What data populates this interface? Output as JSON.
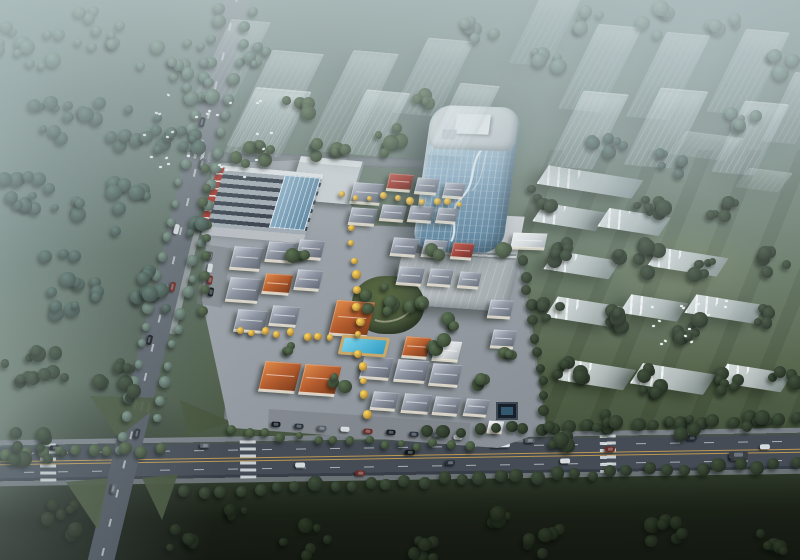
{
  "scene": {
    "kind": "aerial-architectural-rendering",
    "time_of_day": "hazy dusk",
    "no_visible_text": true
  },
  "palette": {
    "mist": "#c3d2d2",
    "lawn_streak": "rgba(22,30,15,0.16)",
    "road_fill_main": "#454c56",
    "road_fill_minor": "#6d747c",
    "sidewalk": "#7a8088",
    "lane_yellow": "#c9a050",
    "lane_white": "rgba(235,240,243,0.6)",
    "median_green": "#46543c",
    "town_base": "#9aa1a8",
    "plaza": "#c6cacd",
    "bigbox_light": "#c2c7ca",
    "bigbox_dark": "#9fa6aa",
    "glass_light": "#cfe0ea",
    "glass_mid": "#8fb4cc",
    "glass_dark": "#4f7894",
    "tower_roof": "#dde2e4",
    "mall_stripe_dark": "#39424d",
    "mall_stripe_light": "#a2abb3",
    "mall_red": "#ab342a",
    "mall_white": "#dfe3e5",
    "pool_light": "#7fd4ea",
    "pool_dark": "#2f9cc4",
    "deck_tan": "#c9a86b",
    "fountain_dark": "#17202a",
    "tree_colors": {
      "hazy": "#5a6d64",
      "forest": "#42544d",
      "dark": "#2e3a2b",
      "mid": "#41513b",
      "yellow": "#c69c42",
      "field": "#20291c"
    },
    "roof_gradients": {
      "grey": "linear-gradient(140deg,#c7ccd6 0%,#8d94a1 45%,#616874 100%)",
      "orange": "linear-gradient(140deg,#e08c4c 0%,#b45c2e 50%,#7c3c1d 100%)",
      "red": "linear-gradient(140deg,#c05b4a 0%,#9c382e 50%,#64231c 100%)",
      "white": "linear-gradient(140deg,#f4f6f7 0%,#d9dde0 55%,#aab0b5 100%)"
    },
    "car_colors": [
      "#14181d",
      "#2b313a",
      "#565c64",
      "#d8dcdf",
      "#6e2a24"
    ]
  },
  "roads": {
    "main": {
      "x1": -10,
      "y1": 457,
      "x2": 810,
      "y2": 457,
      "width": 46,
      "rot_deg": -0.9
    },
    "diagonal": {
      "x1": 238,
      "y1": -6,
      "x2": 100,
      "y2": 565,
      "width": 26,
      "rot_deg": 13.6
    },
    "south_street": {
      "x": 224,
      "y": 416,
      "w": 300,
      "h": 16,
      "rot": 4
    },
    "north_street": {
      "x": 206,
      "y": 156,
      "w": 272,
      "h": 10,
      "rot": 2
    },
    "access_east": {
      "x": 522,
      "y": 258,
      "w": 13,
      "h": 176,
      "rot": -8
    },
    "town_ns": {
      "x": 348,
      "y": 226,
      "w": 12,
      "h": 192,
      "rot": 5
    },
    "town_ew": {
      "x": 234,
      "y": 326,
      "w": 202,
      "h": 10,
      "rot": 4
    }
  },
  "zebras_main_t": [
    58,
    258,
    618
  ],
  "zebras_diag_t": [
    160,
    418
  ],
  "medians": [
    {
      "pts": "90px 396px, 168px 398px, 118px 438px"
    },
    {
      "pts": "180px 400px, 232px 422px, 188px 436px"
    },
    {
      "pts": "66px 482px, 108px 478px, 98px 530px"
    },
    {
      "pts": "142px 478px, 178px 474px, 162px 520px"
    }
  ],
  "ghost_towers": [
    {
      "x": 275,
      "y": 100,
      "w": 52,
      "h": 98,
      "o": 0.5
    },
    {
      "x": 352,
      "y": 102,
      "w": 46,
      "h": 102,
      "o": 0.5
    },
    {
      "x": 433,
      "y": 77,
      "w": 46,
      "h": 76,
      "o": 0.5
    },
    {
      "x": 268,
      "y": 122,
      "w": 56,
      "h": 66,
      "o": 0.65
    },
    {
      "x": 373,
      "y": 123,
      "w": 44,
      "h": 64,
      "o": 0.65
    },
    {
      "x": 463,
      "y": 120,
      "w": 40,
      "h": 72,
      "o": 0.55
    },
    {
      "x": 600,
      "y": 68,
      "w": 44,
      "h": 86,
      "o": 0.55
    },
    {
      "x": 668,
      "y": 76,
      "w": 44,
      "h": 86,
      "o": 0.55
    },
    {
      "x": 748,
      "y": 72,
      "w": 44,
      "h": 84,
      "o": 0.55
    },
    {
      "x": 588,
      "y": 130,
      "w": 46,
      "h": 76,
      "o": 0.65
    },
    {
      "x": 666,
      "y": 128,
      "w": 48,
      "h": 78,
      "o": 0.65
    },
    {
      "x": 750,
      "y": 138,
      "w": 44,
      "h": 72,
      "o": 0.65
    },
    {
      "x": 795,
      "y": 108,
      "w": 34,
      "h": 70,
      "o": 0.5
    },
    {
      "x": 545,
      "y": 30,
      "w": 40,
      "h": 70,
      "o": 0.4
    },
    {
      "x": 232,
      "y": 60,
      "w": 40,
      "h": 80,
      "o": 0.4
    }
  ],
  "ghost_plates": [
    {
      "x": 706,
      "y": 146,
      "w": 58,
      "h": 24,
      "o": 0.4
    },
    {
      "x": 764,
      "y": 180,
      "w": 44,
      "h": 20,
      "o": 0.35
    }
  ],
  "slabs": [
    {
      "x": 590,
      "y": 182,
      "w": 96,
      "h": 20
    },
    {
      "x": 570,
      "y": 217,
      "w": 64,
      "h": 20
    },
    {
      "x": 634,
      "y": 222,
      "w": 62,
      "h": 20
    },
    {
      "x": 582,
      "y": 265,
      "w": 66,
      "h": 20
    },
    {
      "x": 688,
      "y": 262,
      "w": 70,
      "h": 20
    },
    {
      "x": 586,
      "y": 312,
      "w": 70,
      "h": 22
    },
    {
      "x": 654,
      "y": 308,
      "w": 58,
      "h": 20
    },
    {
      "x": 725,
      "y": 309,
      "w": 70,
      "h": 20
    },
    {
      "x": 597,
      "y": 375,
      "w": 66,
      "h": 22
    },
    {
      "x": 673,
      "y": 379,
      "w": 74,
      "h": 22
    },
    {
      "x": 754,
      "y": 378,
      "w": 66,
      "h": 20
    }
  ],
  "houses": [
    {
      "x": 352,
      "y": 183,
      "w": 30,
      "h": 20,
      "rot": 4,
      "roof": "grey"
    },
    {
      "x": 388,
      "y": 174,
      "w": 24,
      "h": 16,
      "rot": 4,
      "roof": "red"
    },
    {
      "x": 416,
      "y": 178,
      "w": 22,
      "h": 15,
      "rot": 4,
      "roof": "grey"
    },
    {
      "x": 444,
      "y": 183,
      "w": 20,
      "h": 14,
      "rot": 4,
      "roof": "grey"
    },
    {
      "x": 350,
      "y": 208,
      "w": 26,
      "h": 16,
      "rot": 4,
      "roof": "grey"
    },
    {
      "x": 381,
      "y": 205,
      "w": 24,
      "h": 15,
      "rot": 4,
      "roof": "grey"
    },
    {
      "x": 409,
      "y": 206,
      "w": 24,
      "h": 15,
      "rot": 4,
      "roof": "grey"
    },
    {
      "x": 437,
      "y": 208,
      "w": 20,
      "h": 14,
      "rot": 4,
      "roof": "grey"
    },
    {
      "x": 512,
      "y": 233,
      "w": 34,
      "h": 15,
      "rot": 2,
      "roof": "white"
    },
    {
      "x": 232,
      "y": 247,
      "w": 30,
      "h": 22,
      "rot": 4,
      "roof": "grey"
    },
    {
      "x": 267,
      "y": 242,
      "w": 27,
      "h": 19,
      "rot": 4,
      "roof": "grey"
    },
    {
      "x": 298,
      "y": 240,
      "w": 25,
      "h": 18,
      "rot": 4,
      "roof": "grey"
    },
    {
      "x": 228,
      "y": 278,
      "w": 32,
      "h": 23,
      "rot": 4,
      "roof": "grey"
    },
    {
      "x": 264,
      "y": 274,
      "w": 27,
      "h": 19,
      "rot": 4,
      "roof": "orange"
    },
    {
      "x": 296,
      "y": 270,
      "w": 25,
      "h": 19,
      "rot": 4,
      "roof": "grey"
    },
    {
      "x": 236,
      "y": 310,
      "w": 30,
      "h": 21,
      "rot": 4,
      "roof": "grey"
    },
    {
      "x": 271,
      "y": 306,
      "w": 27,
      "h": 19,
      "rot": 4,
      "roof": "grey"
    },
    {
      "x": 392,
      "y": 238,
      "w": 25,
      "h": 17,
      "rot": 4,
      "roof": "grey"
    },
    {
      "x": 423,
      "y": 240,
      "w": 23,
      "h": 16,
      "rot": 4,
      "roof": "grey"
    },
    {
      "x": 452,
      "y": 243,
      "w": 21,
      "h": 15,
      "rot": 4,
      "roof": "red"
    },
    {
      "x": 398,
      "y": 267,
      "w": 25,
      "h": 17,
      "rot": 4,
      "roof": "grey"
    },
    {
      "x": 429,
      "y": 269,
      "w": 23,
      "h": 16,
      "rot": 4,
      "roof": "grey"
    },
    {
      "x": 459,
      "y": 272,
      "w": 21,
      "h": 15,
      "rot": 4,
      "roof": "grey"
    },
    {
      "x": 333,
      "y": 301,
      "w": 38,
      "h": 34,
      "rot": 4,
      "roof": "orange"
    },
    {
      "x": 489,
      "y": 300,
      "w": 23,
      "h": 17,
      "rot": 3,
      "roof": "grey"
    },
    {
      "x": 492,
      "y": 330,
      "w": 23,
      "h": 17,
      "rot": 3,
      "roof": "grey"
    },
    {
      "x": 262,
      "y": 362,
      "w": 36,
      "h": 29,
      "rot": 4,
      "roof": "orange"
    },
    {
      "x": 302,
      "y": 365,
      "w": 36,
      "h": 29,
      "rot": 4,
      "roof": "orange"
    },
    {
      "x": 404,
      "y": 337,
      "w": 25,
      "h": 20,
      "rot": 4,
      "roof": "orange"
    },
    {
      "x": 434,
      "y": 341,
      "w": 26,
      "h": 19,
      "rot": 4,
      "roof": "white"
    },
    {
      "x": 362,
      "y": 357,
      "w": 29,
      "h": 21,
      "rot": 4,
      "roof": "grey"
    },
    {
      "x": 396,
      "y": 360,
      "w": 31,
      "h": 21,
      "rot": 4,
      "roof": "grey"
    },
    {
      "x": 431,
      "y": 364,
      "w": 29,
      "h": 21,
      "rot": 4,
      "roof": "grey"
    },
    {
      "x": 372,
      "y": 392,
      "w": 25,
      "h": 17,
      "rot": 4,
      "roof": "grey"
    },
    {
      "x": 403,
      "y": 394,
      "w": 27,
      "h": 18,
      "rot": 4,
      "roof": "grey"
    },
    {
      "x": 434,
      "y": 397,
      "w": 25,
      "h": 17,
      "rot": 4,
      "roof": "grey"
    },
    {
      "x": 465,
      "y": 399,
      "w": 23,
      "h": 16,
      "rot": 4,
      "roof": "grey"
    },
    {
      "x": 488,
      "y": 421,
      "w": 15,
      "h": 11,
      "rot": 3,
      "roof": "white"
    }
  ],
  "tree_lines": [
    {
      "x1": 221,
      "y1": 6,
      "x2": 117,
      "y2": 452,
      "n": 26,
      "c": "hazy",
      "s": [
        8,
        13
      ]
    },
    {
      "x1": 251,
      "y1": 10,
      "x2": 158,
      "y2": 418,
      "n": 24,
      "c": "hazy",
      "s": [
        8,
        12
      ]
    },
    {
      "x1": 160,
      "y1": 450,
      "x2": 8,
      "y2": 452,
      "n": 10,
      "c": "mid",
      "s": [
        9,
        13
      ]
    },
    {
      "x1": 430,
      "y1": 432,
      "x2": 795,
      "y2": 418,
      "n": 24,
      "c": "dark",
      "s": [
        10,
        14
      ]
    },
    {
      "x1": 185,
      "y1": 492,
      "x2": 795,
      "y2": 464,
      "n": 34,
      "c": "dark",
      "s": [
        10,
        15
      ]
    },
    {
      "x1": 232,
      "y1": 432,
      "x2": 468,
      "y2": 448,
      "n": 15,
      "c": "mid",
      "s": [
        7,
        10
      ]
    },
    {
      "x1": 524,
      "y1": 262,
      "x2": 548,
      "y2": 428,
      "n": 12,
      "c": "dark",
      "s": [
        9,
        12
      ]
    },
    {
      "x1": 349,
      "y1": 230,
      "x2": 366,
      "y2": 412,
      "n": 13,
      "c": "yellow",
      "s": [
        6,
        9
      ]
    },
    {
      "x1": 238,
      "y1": 330,
      "x2": 332,
      "y2": 338,
      "n": 8,
      "c": "yellow",
      "s": [
        6,
        8
      ]
    },
    {
      "x1": 344,
      "y1": 196,
      "x2": 462,
      "y2": 202,
      "n": 10,
      "c": "yellow",
      "s": [
        5,
        8
      ]
    },
    {
      "x1": 205,
      "y1": 170,
      "x2": 204,
      "y2": 310,
      "n": 9,
      "c": "mid",
      "s": [
        8,
        11
      ]
    }
  ],
  "tree_clusters": [
    {
      "x": 30,
      "y": 45,
      "r": 34,
      "n": 12,
      "c": "hazy"
    },
    {
      "x": 100,
      "y": 28,
      "r": 30,
      "n": 10,
      "c": "hazy"
    },
    {
      "x": 172,
      "y": 58,
      "r": 34,
      "n": 11,
      "c": "hazy"
    },
    {
      "x": 62,
      "y": 112,
      "r": 40,
      "n": 13,
      "c": "forest"
    },
    {
      "x": 142,
      "y": 132,
      "r": 34,
      "n": 11,
      "c": "forest"
    },
    {
      "x": 36,
      "y": 192,
      "r": 38,
      "n": 12,
      "c": "forest"
    },
    {
      "x": 112,
      "y": 208,
      "r": 40,
      "n": 13,
      "c": "forest"
    },
    {
      "x": 62,
      "y": 282,
      "r": 44,
      "n": 14,
      "c": "forest"
    },
    {
      "x": 152,
      "y": 292,
      "r": 32,
      "n": 10,
      "c": "forest"
    },
    {
      "x": 42,
      "y": 362,
      "r": 40,
      "n": 12,
      "c": "dark"
    },
    {
      "x": 122,
      "y": 382,
      "r": 36,
      "n": 11,
      "c": "dark"
    },
    {
      "x": 36,
      "y": 444,
      "r": 30,
      "n": 9,
      "c": "dark"
    },
    {
      "x": 185,
      "y": 142,
      "r": 20,
      "n": 6,
      "c": "forest"
    },
    {
      "x": 200,
      "y": 92,
      "r": 16,
      "n": 5,
      "c": "hazy"
    },
    {
      "x": 252,
      "y": 158,
      "r": 24,
      "n": 7,
      "c": "mid"
    },
    {
      "x": 328,
      "y": 150,
      "r": 22,
      "n": 6,
      "c": "mid"
    },
    {
      "x": 300,
      "y": 106,
      "r": 18,
      "n": 5,
      "c": "mid"
    },
    {
      "x": 392,
      "y": 140,
      "r": 20,
      "n": 6,
      "c": "mid"
    },
    {
      "x": 428,
      "y": 98,
      "r": 14,
      "n": 4,
      "c": "mid"
    },
    {
      "x": 258,
      "y": 56,
      "r": 18,
      "n": 5,
      "c": "hazy"
    },
    {
      "x": 545,
      "y": 62,
      "r": 18,
      "n": 5,
      "c": "hazy"
    },
    {
      "x": 608,
      "y": 142,
      "r": 20,
      "n": 6,
      "c": "forest"
    },
    {
      "x": 678,
      "y": 162,
      "r": 22,
      "n": 6,
      "c": "forest"
    },
    {
      "x": 742,
      "y": 120,
      "r": 18,
      "n": 5,
      "c": "hazy"
    },
    {
      "x": 780,
      "y": 62,
      "r": 16,
      "n": 4,
      "c": "hazy"
    },
    {
      "x": 592,
      "y": 22,
      "r": 18,
      "n": 5,
      "c": "hazy"
    },
    {
      "x": 660,
      "y": 20,
      "r": 22,
      "n": 6,
      "c": "hazy"
    },
    {
      "x": 724,
      "y": 18,
      "r": 20,
      "n": 5,
      "c": "hazy"
    },
    {
      "x": 480,
      "y": 30,
      "r": 20,
      "n": 6,
      "c": "hazy"
    },
    {
      "x": 540,
      "y": 198,
      "r": 16,
      "n": 5,
      "c": "dark"
    },
    {
      "x": 648,
      "y": 210,
      "r": 20,
      "n": 7,
      "c": "dark"
    },
    {
      "x": 722,
      "y": 212,
      "r": 18,
      "n": 6,
      "c": "dark"
    },
    {
      "x": 560,
      "y": 252,
      "r": 18,
      "n": 6,
      "c": "dark"
    },
    {
      "x": 640,
      "y": 258,
      "r": 22,
      "n": 8,
      "c": "dark"
    },
    {
      "x": 706,
      "y": 268,
      "r": 18,
      "n": 6,
      "c": "dark"
    },
    {
      "x": 772,
      "y": 262,
      "r": 16,
      "n": 5,
      "c": "dark"
    },
    {
      "x": 548,
      "y": 308,
      "r": 16,
      "n": 5,
      "c": "dark"
    },
    {
      "x": 618,
      "y": 322,
      "r": 20,
      "n": 7,
      "c": "dark"
    },
    {
      "x": 692,
      "y": 330,
      "r": 18,
      "n": 6,
      "c": "dark"
    },
    {
      "x": 766,
      "y": 318,
      "r": 16,
      "n": 5,
      "c": "dark"
    },
    {
      "x": 572,
      "y": 372,
      "r": 18,
      "n": 6,
      "c": "dark"
    },
    {
      "x": 652,
      "y": 382,
      "r": 20,
      "n": 7,
      "c": "dark"
    },
    {
      "x": 724,
      "y": 384,
      "r": 18,
      "n": 6,
      "c": "dark"
    },
    {
      "x": 784,
      "y": 378,
      "r": 14,
      "n": 4,
      "c": "dark"
    },
    {
      "x": 604,
      "y": 420,
      "r": 16,
      "n": 5,
      "c": "dark"
    },
    {
      "x": 684,
      "y": 424,
      "r": 16,
      "n": 5,
      "c": "dark"
    },
    {
      "x": 756,
      "y": 424,
      "r": 14,
      "n": 4,
      "c": "dark"
    },
    {
      "x": 560,
      "y": 440,
      "r": 14,
      "n": 5,
      "c": "dark"
    },
    {
      "x": 64,
      "y": 520,
      "r": 24,
      "n": 7,
      "c": "field"
    },
    {
      "x": 184,
      "y": 536,
      "r": 22,
      "n": 6,
      "c": "field"
    },
    {
      "x": 304,
      "y": 540,
      "r": 24,
      "n": 7,
      "c": "field"
    },
    {
      "x": 424,
      "y": 544,
      "r": 22,
      "n": 6,
      "c": "field"
    },
    {
      "x": 544,
      "y": 538,
      "r": 24,
      "n": 7,
      "c": "field"
    },
    {
      "x": 664,
      "y": 534,
      "r": 24,
      "n": 7,
      "c": "field"
    },
    {
      "x": 772,
      "y": 540,
      "r": 20,
      "n": 5,
      "c": "field"
    },
    {
      "x": 234,
      "y": 512,
      "r": 14,
      "n": 4,
      "c": "field"
    },
    {
      "x": 494,
      "y": 516,
      "r": 14,
      "n": 4,
      "c": "field"
    },
    {
      "x": 300,
      "y": 256,
      "r": 10,
      "n": 3,
      "c": "mid"
    },
    {
      "x": 414,
      "y": 300,
      "r": 11,
      "n": 4,
      "c": "mid"
    },
    {
      "x": 452,
      "y": 322,
      "r": 9,
      "n": 3,
      "c": "mid"
    },
    {
      "x": 290,
      "y": 346,
      "r": 9,
      "n": 3,
      "c": "mid"
    },
    {
      "x": 338,
      "y": 382,
      "r": 10,
      "n": 3,
      "c": "mid"
    },
    {
      "x": 442,
      "y": 346,
      "r": 9,
      "n": 3,
      "c": "mid"
    },
    {
      "x": 478,
      "y": 382,
      "r": 9,
      "n": 3,
      "c": "mid"
    },
    {
      "x": 508,
      "y": 352,
      "r": 9,
      "n": 3,
      "c": "mid"
    },
    {
      "x": 382,
      "y": 300,
      "r": 20,
      "n": 7,
      "c": "mid"
    },
    {
      "x": 198,
      "y": 228,
      "r": 11,
      "n": 4,
      "c": "forest"
    },
    {
      "x": 436,
      "y": 252,
      "r": 7,
      "n": 2,
      "c": "mid"
    },
    {
      "x": 506,
      "y": 254,
      "r": 7,
      "n": 2,
      "c": "mid"
    }
  ],
  "bird_flocks": [
    {
      "x": 205,
      "y": 135,
      "rx": 70,
      "ry": 45,
      "n": 26
    },
    {
      "x": 688,
      "y": 322,
      "rx": 40,
      "ry": 22,
      "n": 14
    }
  ],
  "cars_main_road": [
    {
      "t": 65,
      "l": -15
    },
    {
      "t": 130,
      "l": -5
    },
    {
      "t": 215,
      "l": -15
    },
    {
      "t": 310,
      "l": 6
    },
    {
      "t": 370,
      "l": 15
    },
    {
      "t": 420,
      "l": -5
    },
    {
      "t": 460,
      "l": 6
    },
    {
      "t": 540,
      "l": -15
    },
    {
      "t": 575,
      "l": 6
    },
    {
      "t": 620,
      "l": -5
    },
    {
      "t": 660,
      "l": 15
    },
    {
      "t": 702,
      "l": -15
    },
    {
      "t": 745,
      "l": 6
    },
    {
      "t": 775,
      "l": -5
    }
  ],
  "trucks_main_road": [
    {
      "t": 510,
      "l": -12,
      "c": "#dde2e4"
    },
    {
      "t": 748,
      "l": 3,
      "c": "#3a4046"
    }
  ],
  "cars_diag_road": [
    {
      "t": 128,
      "l": -5
    },
    {
      "t": 168,
      "l": 5
    },
    {
      "t": 238,
      "l": -5
    },
    {
      "t": 295,
      "l": 5
    },
    {
      "t": 352,
      "l": -5
    },
    {
      "t": 446,
      "l": 5
    },
    {
      "t": 505,
      "l": -5
    }
  ],
  "cars_parking_south": [
    {
      "x": 276,
      "y": 424
    },
    {
      "x": 299,
      "y": 426
    },
    {
      "x": 322,
      "y": 428
    },
    {
      "x": 345,
      "y": 429
    },
    {
      "x": 368,
      "y": 431
    },
    {
      "x": 391,
      "y": 432
    },
    {
      "x": 414,
      "y": 434
    },
    {
      "x": 437,
      "y": 435
    },
    {
      "x": 458,
      "y": 437
    }
  ],
  "cars_parking_west": [
    {
      "x": 210,
      "y": 256
    },
    {
      "x": 210,
      "y": 268
    },
    {
      "x": 210,
      "y": 280
    },
    {
      "x": 211,
      "y": 292
    }
  ]
}
